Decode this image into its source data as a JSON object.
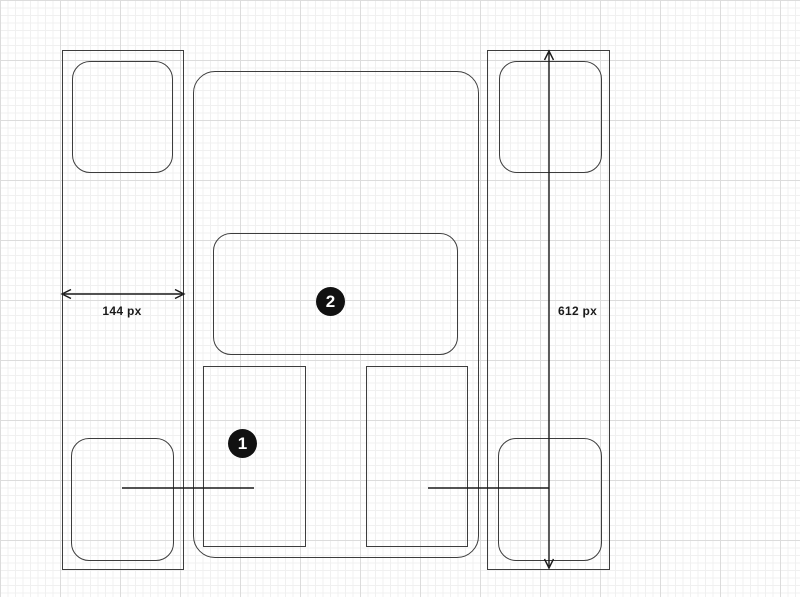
{
  "canvas": {
    "background_color": "#ffffff",
    "grid_minor_color": "#f0f0f0",
    "grid_major_color": "#dcdcdc",
    "shape_stroke_color": "#3d3d3d",
    "annotation_color": "#1a1a1a",
    "marker_background_color": "#111111",
    "marker_text_color": "#ffffff"
  },
  "dimensions": {
    "width_label": "144 px",
    "height_label": "612 px"
  },
  "markers": {
    "one": "1",
    "two": "2"
  }
}
